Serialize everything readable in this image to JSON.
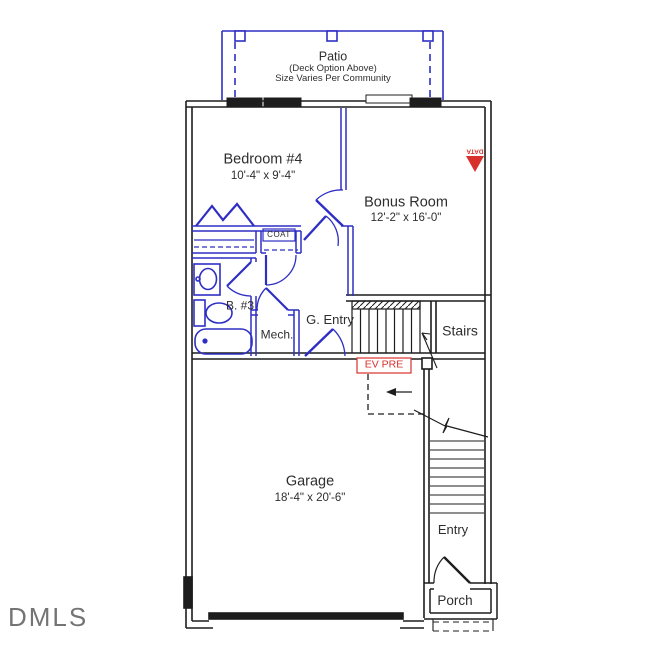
{
  "plan": {
    "watermark": "DMLS",
    "patio": {
      "title": "Patio",
      "note1": "(Deck Option Above)",
      "note2": "Size Varies Per Community"
    },
    "rooms": {
      "bedroom4": {
        "name": "Bedroom #4",
        "dims": "10'-4\" x 9'-4\""
      },
      "bonus_room": {
        "name": "Bonus Room",
        "dims": "12'-2\" x 16'-0\""
      },
      "garage": {
        "name": "Garage",
        "dims": "18'-4\" x 20'-6\""
      },
      "coat_closet": {
        "name": "COAT"
      },
      "bath3": {
        "name": "B. #3"
      },
      "mech": {
        "name": "Mech."
      },
      "garage_entry": {
        "name": "G. Entry"
      },
      "stairs": {
        "name": "Stairs"
      },
      "entry": {
        "name": "Entry"
      },
      "porch": {
        "name": "Porch"
      }
    },
    "annotations": {
      "ev_pre": "EV PRE",
      "data_label": "DATA"
    },
    "colors": {
      "exterior_wall": "#1d1d1d",
      "interior_wall": "#2e2ec4",
      "annotation_red": "#d8312c",
      "watermark_gray": "#5c5c5c",
      "background": "#ffffff"
    }
  }
}
